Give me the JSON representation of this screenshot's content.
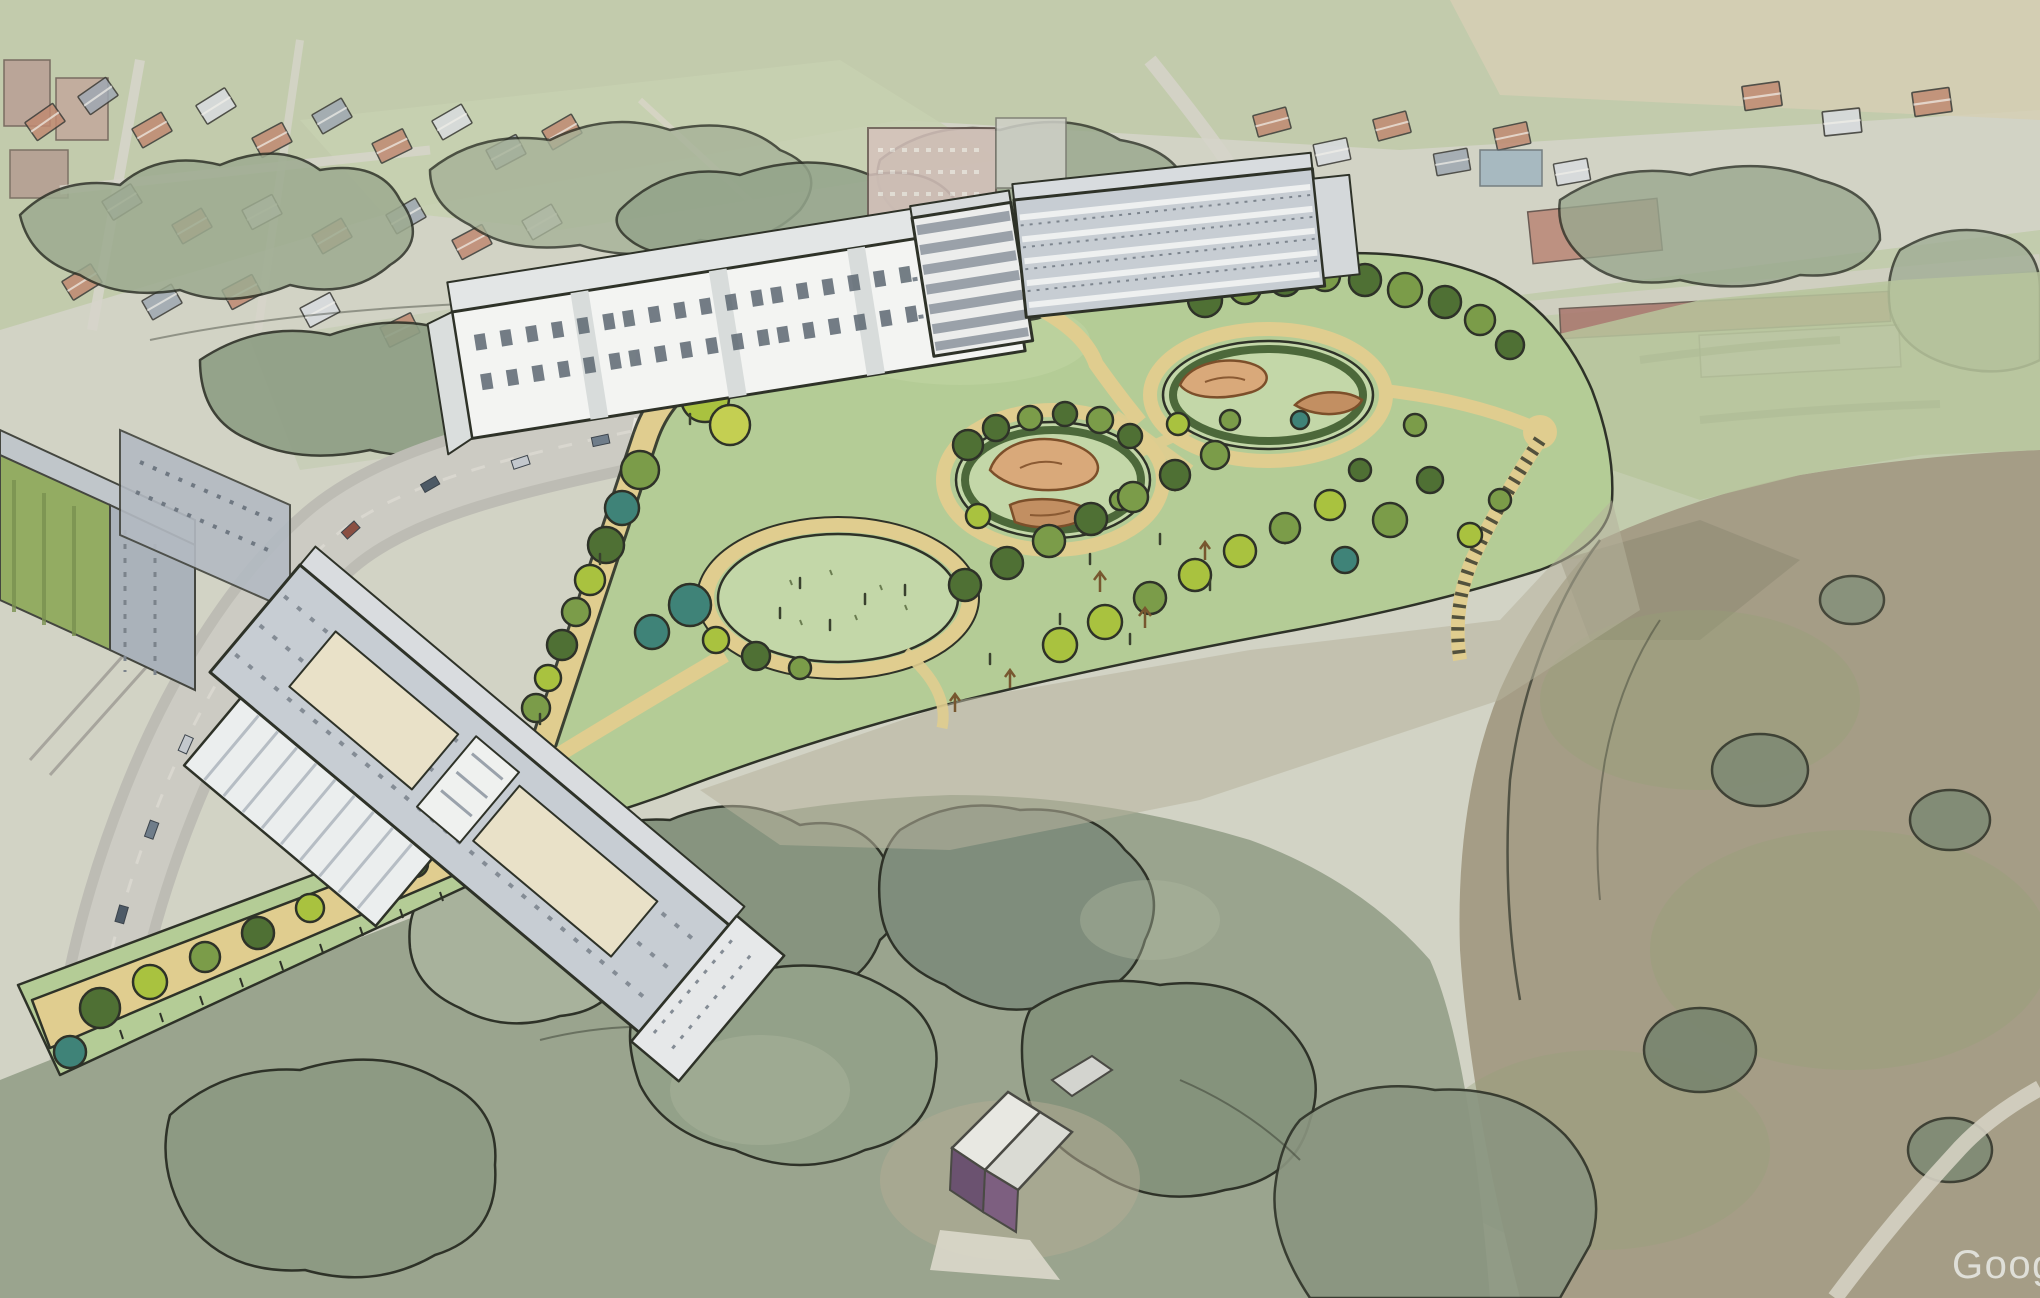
{
  "scene": {
    "kind": "aerial-photo-with-sketch-render",
    "elements": [
      "existing-village-context",
      "west-road",
      "proposed-white-buildings",
      "proposed-park",
      "playground-ovals",
      "circular-lawn",
      "tree-lined-path",
      "south-woodland",
      "east-rough-meadow",
      "maintenance-hut",
      "google-watermark"
    ]
  },
  "watermark": {
    "text": "Google"
  },
  "palette": {
    "ink": "#2e3228",
    "park_green": "#b4cc96",
    "lawn_light": "#c3d7a8",
    "path_tan": "#e0cd8f",
    "sand_play": "#d9a97a",
    "sand_play_dark": "#c28f62",
    "hedge_dark": "#3f5c2e",
    "tree_dark": "#4f7034",
    "tree_mid": "#7b9c49",
    "tree_bright": "#a9c23f",
    "tree_yellow": "#c4cf52",
    "tree_teal": "#3f8378",
    "building_white": "#f3f4f2",
    "building_gray": "#c7cdd3",
    "roof_light": "#e3e6e6",
    "roof_red_faded": "#c08a72",
    "road_gray": "#cccbc3",
    "woodland_dark": "#7f8d7c",
    "woodland_mid": "#93a189",
    "woodland_light": "#a8b29c",
    "meadow_rough": "#a59d86",
    "field_green": "#c0caa9",
    "hut_purple": "#7d5f80",
    "watermark": "#e4e5df"
  }
}
